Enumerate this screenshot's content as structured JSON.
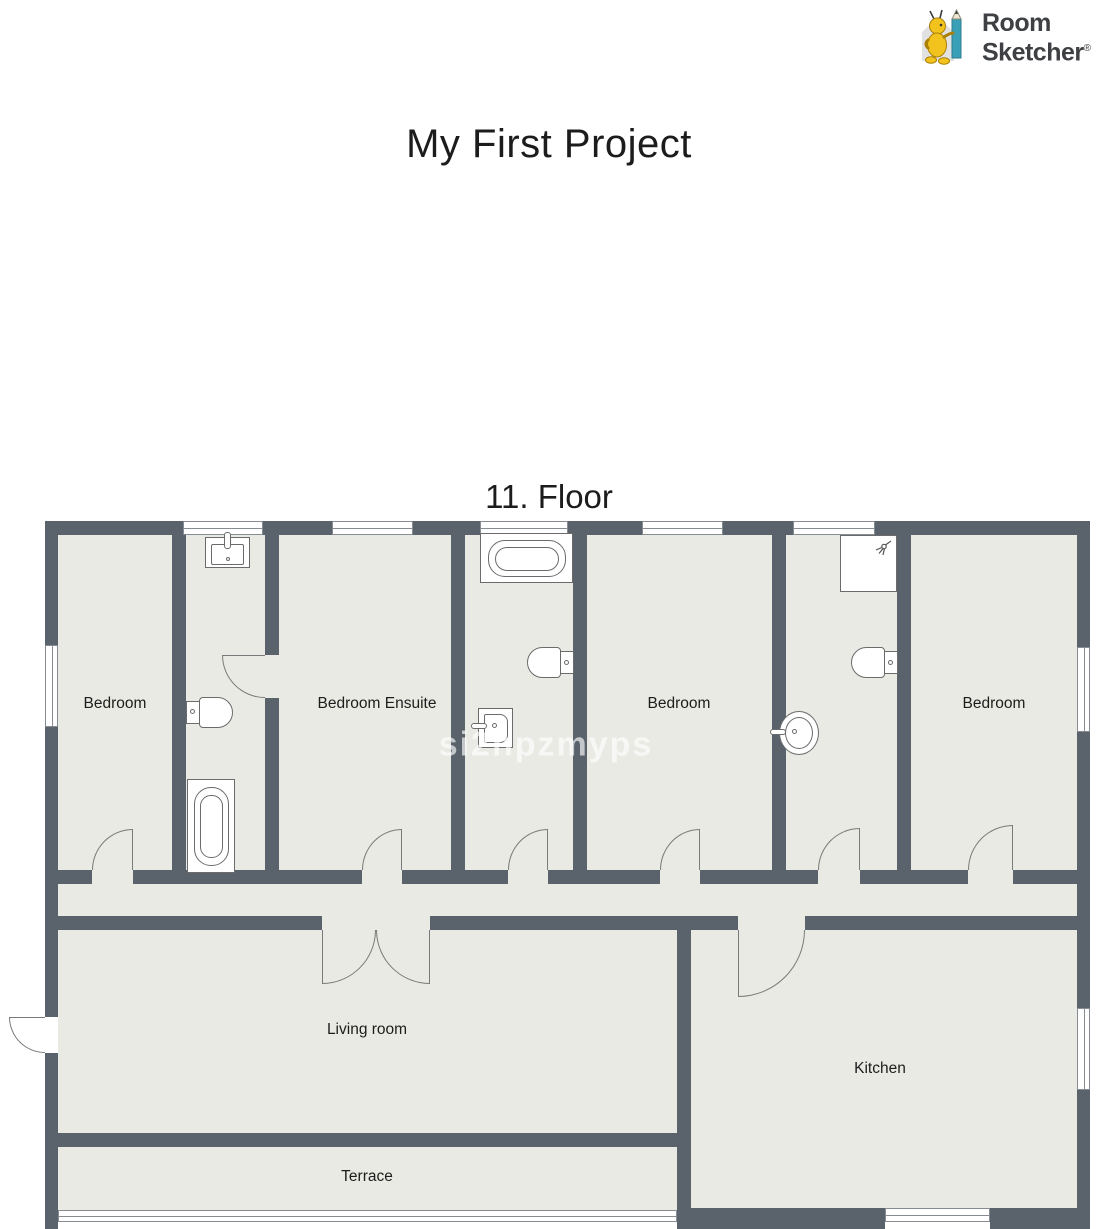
{
  "logo": {
    "name": "RoomSketcher",
    "line1": "Room",
    "line2": "Sketcher",
    "registered_mark": "®",
    "mascot_icon": "roomsketcher-mascot-with-pencil"
  },
  "page": {
    "title": "My First Project",
    "floor_label": "11. Floor",
    "watermark": "si2npzmyps"
  },
  "rooms": {
    "bedroom_1": {
      "label": "Bedroom"
    },
    "bedroom_ensuite": {
      "label": "Bedroom Ensuite"
    },
    "bedroom_2": {
      "label": "Bedroom"
    },
    "bedroom_3": {
      "label": "Bedroom"
    },
    "living_room": {
      "label": "Living room"
    },
    "kitchen": {
      "label": "Kitchen"
    },
    "terrace": {
      "label": "Terrace"
    }
  },
  "fixtures": [
    "vanity-sink",
    "toilet",
    "bathtub",
    "bathtub",
    "toilet",
    "wall-basin",
    "shower",
    "toilet",
    "pedestal-washbasin"
  ],
  "colors": {
    "background": "#ffffff",
    "wall": "#5a626c",
    "floor": "#e9eae3",
    "fixture_line": "#6b6b6b",
    "door_line": "#7a7a7a",
    "label_text": "#1d1d1d",
    "logo_text": "#3e4043",
    "mascot_yellow": "#f2c31c",
    "pencil_teal": "#3aa0b7",
    "watermark_color": "rgba(255,255,255,0.65)"
  }
}
